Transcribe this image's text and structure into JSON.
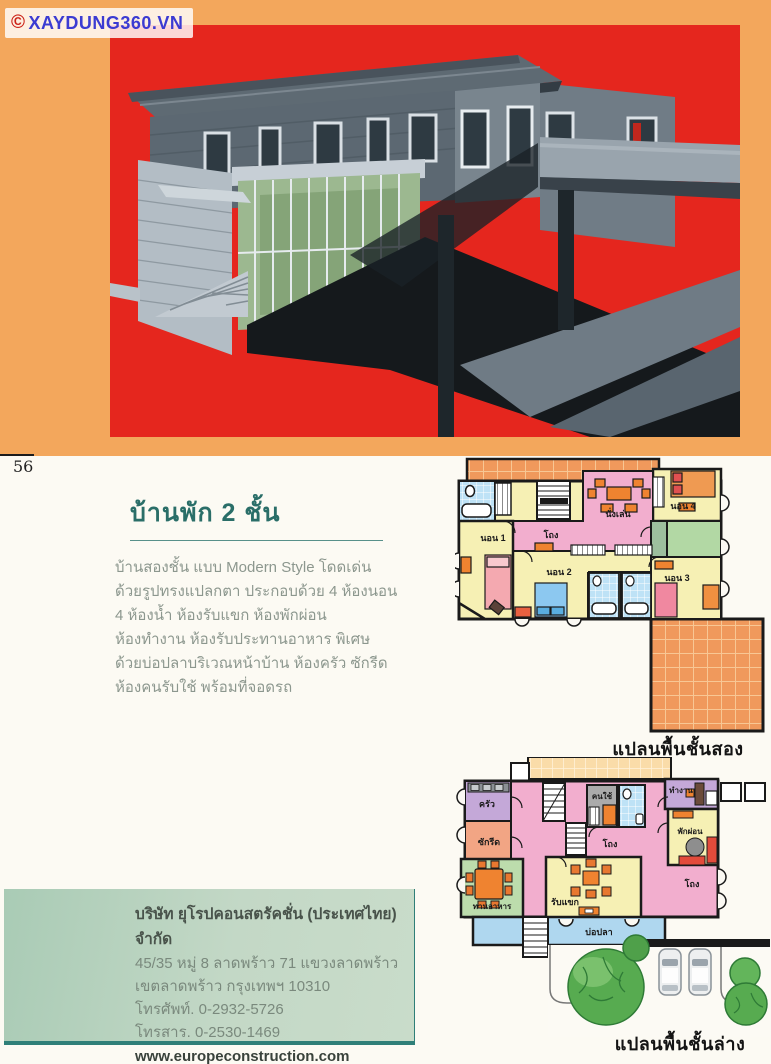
{
  "watermark": {
    "copyright": "©",
    "text": "XAYDUNG360.VN"
  },
  "page": {
    "number": "56"
  },
  "article": {
    "title": "บ้านพัก 2 ชั้น",
    "body_lines": [
      "บ้านสองชั้น แบบ Modern Style โดดเด่น",
      "ด้วยรูปทรงแปลกตา ประกอบด้วย 4 ห้องนอน",
      "4 ห้องน้ำ ห้องรับแขก ห้องพักผ่อน",
      "ห้องทำงาน ห้องรับประทานอาหาร พิเศษ",
      "ด้วยบ่อปลาบริเวณหน้าบ้าน ห้องครัว ซักรีด",
      "ห้องคนรับใช้ พร้อมที่จอดรถ"
    ]
  },
  "plans": {
    "second_floor": {
      "caption": "แปลนพื้นชั้นสอง",
      "rooms": [
        {
          "label": "นอน 1"
        },
        {
          "label": "นอน 2"
        },
        {
          "label": "นอน 3"
        },
        {
          "label": "นอน 4"
        },
        {
          "label": "โถง"
        },
        {
          "label": "นั่งเล่น"
        }
      ]
    },
    "ground_floor": {
      "caption": "แปลนพื้นชั้นล่าง",
      "rooms": [
        {
          "label": "ครัว"
        },
        {
          "label": "ซักรีด"
        },
        {
          "label": "ทานอาหาร"
        },
        {
          "label": "รับแขก"
        },
        {
          "label": "โถง"
        },
        {
          "label": "คนใช้"
        },
        {
          "label": "ทำงาน"
        },
        {
          "label": "พักผ่อน"
        },
        {
          "label": "โถง"
        },
        {
          "label": "บ่อปลา"
        }
      ]
    }
  },
  "contact": {
    "company": "บริษัท ยุโรปคอนสตรัคชั่น (ประเทศไทย) จำกัด",
    "address_line1": "45/35 หมู่ 8 ลาดพร้าว 71 แขวงลาดพร้าว",
    "address_line2": "เขตลาดพร้าว กรุงเทพฯ 10310",
    "phone": "โทรศัพท์. 0-2932-5726",
    "fax": "โทรสาร. 0-2530-1469",
    "website": "www.europeconstruction.com"
  },
  "colors": {
    "banner_orange": "#F3A75C",
    "render_red": "#E5261E",
    "title_teal": "#2A6E68",
    "contact_box_green": "#C3D8C6",
    "contact_rule_teal": "#2F7F78",
    "room_yellow": "#F6F0B4",
    "hall_pink": "#F2AECE",
    "tile_orange": "#F0995C",
    "bath_blue": "#BEE2F6",
    "room_green": "#B2D8A4",
    "room_purple": "#C4A8D8",
    "room_salmon": "#F2A584",
    "dining_green": "#BCDCAC",
    "pond_blue": "#AFD7EF",
    "maid_gray": "#ABABAB",
    "furniture_orange": "#EF8330",
    "tree_green": "#57AB50"
  }
}
